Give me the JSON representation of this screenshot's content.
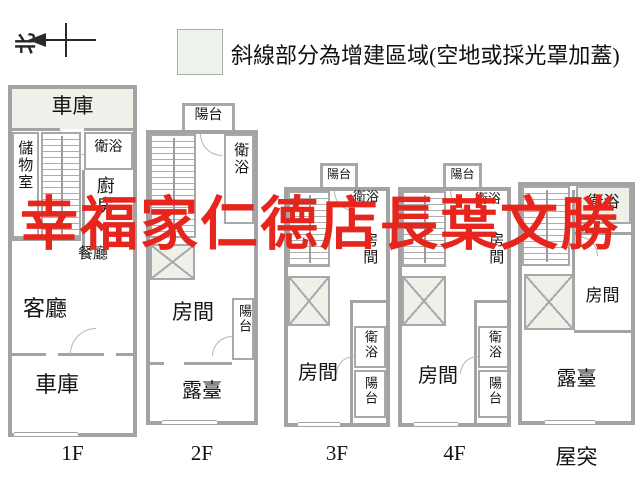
{
  "legend": {
    "text": "斜線部分為增建區域(空地或採光罩加蓋)",
    "swatch_color": "#eef2ec"
  },
  "north": {
    "label": "北"
  },
  "watermark": {
    "text": "幸福家仁德店長葉文勝",
    "color": "#e6251d"
  },
  "colors": {
    "wall": "#a3a3a3",
    "addition_shade": "#edf1e9"
  },
  "floors": [
    {
      "label": "1F",
      "rooms": {
        "garage_top": "車庫",
        "storage": "儲物室",
        "bath": "衛浴",
        "kitchen": "廚房",
        "dining": "餐廳",
        "living": "客廳",
        "garage_bottom": "車庫"
      }
    },
    {
      "label": "2F",
      "rooms": {
        "balcony_top": "陽台",
        "bath": "衛浴",
        "room": "房間",
        "balcony_right": "陽台",
        "terrace": "露臺"
      }
    },
    {
      "label": "3F",
      "rooms": {
        "balcony_top": "陽台",
        "bath_top": "衛浴",
        "room_upper": "房間",
        "room": "房間",
        "bath_right": "衛浴",
        "balcony_right": "陽台"
      }
    },
    {
      "label": "4F",
      "rooms": {
        "balcony_top": "陽台",
        "bath_top": "衛浴",
        "room_upper": "房間",
        "room": "房間",
        "bath_right": "衛浴",
        "balcony_right": "陽台"
      }
    },
    {
      "label": "屋突",
      "rooms": {
        "bath": "衛浴",
        "room": "房間",
        "terrace": "露臺"
      }
    }
  ]
}
